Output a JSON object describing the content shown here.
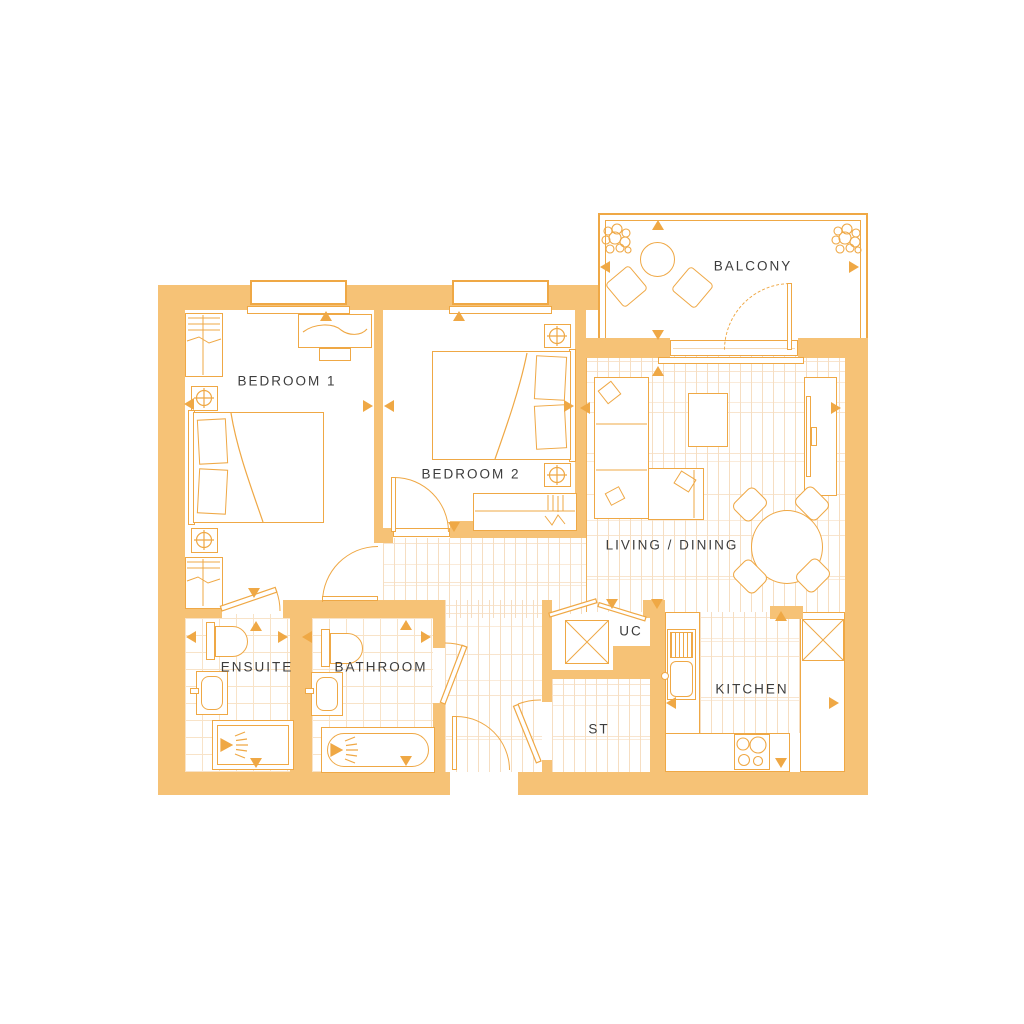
{
  "title": "Two bedroom apartment floorplan",
  "rooms": {
    "bedroom1": {
      "label": "BEDROOM 1"
    },
    "bedroom2": {
      "label": "BEDROOM 2"
    },
    "living_dining": {
      "label": "LIVING / DINING"
    },
    "kitchen": {
      "label": "KITCHEN"
    },
    "balcony": {
      "label": "BALCONY"
    },
    "ensuite": {
      "label": "ENSUITE"
    },
    "bathroom": {
      "label": "BATHROOM"
    },
    "utility_cupboard": {
      "label": "UC"
    },
    "storage": {
      "label": "ST"
    }
  },
  "colors": {
    "wall": "#F6C276",
    "line": "#EFA845",
    "line_soft": "#F5D9B4",
    "plank": "#F6DEC2",
    "tile": "#F8E3C8",
    "text": "#3D3D3D",
    "background": "#FFFFFF"
  }
}
